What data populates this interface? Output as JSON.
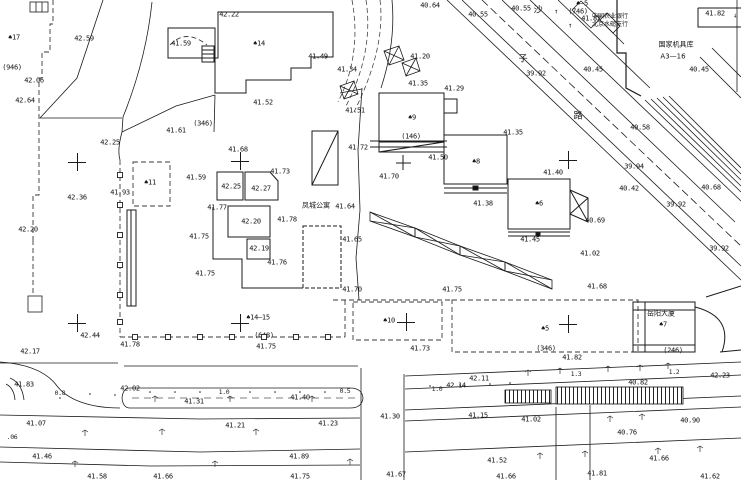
{
  "canvas": {
    "width": 741,
    "height": 480,
    "background": "#ffffff",
    "line_color": "#1b1b1b"
  },
  "annotations": [
    {
      "t": "40.64",
      "x": 430,
      "y": 6,
      "c": "e"
    },
    {
      "t": "40.55",
      "x": 478,
      "y": 15,
      "c": "e"
    },
    {
      "t": "40.55",
      "x": 521,
      "y": 9,
      "c": "e"
    },
    {
      "t": "♠—5",
      "x": 582,
      "y": 4,
      "c": "b"
    },
    {
      "t": "(746)",
      "x": 578,
      "y": 12,
      "c": "b"
    },
    {
      "t": "41.82",
      "x": 591,
      "y": 19,
      "c": "e"
    },
    {
      "t": "中国农业银行",
      "x": 610,
      "y": 17,
      "c": "n2"
    },
    {
      "t": "北京水磓支行",
      "x": 610,
      "y": 25,
      "c": "n2"
    },
    {
      "t": "国家机具库",
      "x": 676,
      "y": 45,
      "c": "n"
    },
    {
      "t": "A3—16",
      "x": 673,
      "y": 57,
      "c": "n"
    },
    {
      "t": "41.82",
      "x": 715,
      "y": 14,
      "c": "e"
    },
    {
      "t": "↓",
      "x": 735,
      "y": 16,
      "c": "s"
    },
    {
      "t": "↑",
      "x": 556,
      "y": 12,
      "c": "s"
    },
    {
      "t": "↑",
      "x": 570,
      "y": 26,
      "c": "s"
    },
    {
      "t": "40.45",
      "x": 699,
      "y": 70,
      "c": "e"
    },
    {
      "t": "40.45",
      "x": 593,
      "y": 70,
      "c": "e"
    },
    {
      "t": "39.92",
      "x": 536,
      "y": 74,
      "c": "e"
    },
    {
      "t": "沙",
      "x": 538,
      "y": 11,
      "c": "c"
    },
    {
      "t": "子",
      "x": 523,
      "y": 60,
      "c": "c"
    },
    {
      "t": "路",
      "x": 578,
      "y": 117,
      "c": "c"
    },
    {
      "t": "40.58",
      "x": 640,
      "y": 128,
      "c": "e"
    },
    {
      "t": "39.94",
      "x": 634,
      "y": 167,
      "c": "e"
    },
    {
      "t": "40.42",
      "x": 629,
      "y": 189,
      "c": "e"
    },
    {
      "t": "40.68",
      "x": 711,
      "y": 188,
      "c": "e"
    },
    {
      "t": "39.92",
      "x": 676,
      "y": 205,
      "c": "e"
    },
    {
      "t": "39.92",
      "x": 719,
      "y": 249,
      "c": "e"
    },
    {
      "t": "42.22",
      "x": 229,
      "y": 15,
      "c": "e"
    },
    {
      "t": "42.59",
      "x": 84,
      "y": 39,
      "c": "e"
    },
    {
      "t": "♠17",
      "x": 14,
      "y": 38,
      "c": "b"
    },
    {
      "t": "(946)",
      "x": 12,
      "y": 68,
      "c": "b"
    },
    {
      "t": "42.06",
      "x": 34,
      "y": 81,
      "c": "e"
    },
    {
      "t": "42.64",
      "x": 25,
      "y": 101,
      "c": "e"
    },
    {
      "t": "42.25",
      "x": 110,
      "y": 143,
      "c": "e"
    },
    {
      "t": "41.59",
      "x": 181,
      "y": 44,
      "c": "e"
    },
    {
      "t": "41.61",
      "x": 176,
      "y": 131,
      "c": "e"
    },
    {
      "t": "(346)",
      "x": 203,
      "y": 124,
      "c": "b"
    },
    {
      "t": "♠14",
      "x": 259,
      "y": 44,
      "c": "b"
    },
    {
      "t": "41.52",
      "x": 263,
      "y": 103,
      "c": "e"
    },
    {
      "t": "41.49",
      "x": 318,
      "y": 57,
      "c": "e"
    },
    {
      "t": "41.51",
      "x": 355,
      "y": 111,
      "c": "e"
    },
    {
      "t": "41.34",
      "x": 347,
      "y": 70,
      "c": "e"
    },
    {
      "t": "41.20",
      "x": 420,
      "y": 57,
      "c": "e"
    },
    {
      "t": "41.29",
      "x": 454,
      "y": 89,
      "c": "e"
    },
    {
      "t": "41.35",
      "x": 418,
      "y": 84,
      "c": "e"
    },
    {
      "t": "41.35",
      "x": 513,
      "y": 133,
      "c": "e"
    },
    {
      "t": "41.72",
      "x": 358,
      "y": 148,
      "c": "e"
    },
    {
      "t": "41.50",
      "x": 438,
      "y": 158,
      "c": "e"
    },
    {
      "t": "41.70",
      "x": 389,
      "y": 177,
      "c": "e"
    },
    {
      "t": "♠9",
      "x": 412,
      "y": 118,
      "c": "b"
    },
    {
      "t": "(146)",
      "x": 411,
      "y": 137,
      "c": "b"
    },
    {
      "t": "♠8",
      "x": 476,
      "y": 162,
      "c": "b"
    },
    {
      "t": "41.38",
      "x": 483,
      "y": 204,
      "c": "e"
    },
    {
      "t": "♠6",
      "x": 539,
      "y": 204,
      "c": "b"
    },
    {
      "t": "41.40",
      "x": 553,
      "y": 173,
      "c": "e"
    },
    {
      "t": "41.45",
      "x": 530,
      "y": 240,
      "c": "e"
    },
    {
      "t": "40.69",
      "x": 595,
      "y": 221,
      "c": "e"
    },
    {
      "t": "41.02",
      "x": 590,
      "y": 254,
      "c": "e"
    },
    {
      "t": "41.68",
      "x": 597,
      "y": 287,
      "c": "e"
    },
    {
      "t": "42.36",
      "x": 77,
      "y": 198,
      "c": "e"
    },
    {
      "t": "42.20",
      "x": 28,
      "y": 230,
      "c": "e"
    },
    {
      "t": "41.93",
      "x": 120,
      "y": 193,
      "c": "e"
    },
    {
      "t": "♠11",
      "x": 150,
      "y": 183,
      "c": "b"
    },
    {
      "t": "41.59",
      "x": 196,
      "y": 178,
      "c": "e"
    },
    {
      "t": "41.68",
      "x": 238,
      "y": 150,
      "c": "e"
    },
    {
      "t": "41.73",
      "x": 280,
      "y": 172,
      "c": "e"
    },
    {
      "t": "42.25",
      "x": 231,
      "y": 187,
      "c": "e"
    },
    {
      "t": "42.27",
      "x": 261,
      "y": 189,
      "c": "e"
    },
    {
      "t": "41.77",
      "x": 217,
      "y": 208,
      "c": "e"
    },
    {
      "t": "42.20",
      "x": 251,
      "y": 222,
      "c": "e"
    },
    {
      "t": "41.78",
      "x": 287,
      "y": 220,
      "c": "e"
    },
    {
      "t": "41.64",
      "x": 345,
      "y": 207,
      "c": "e"
    },
    {
      "t": "凤城公寓",
      "x": 316,
      "y": 206,
      "c": "n"
    },
    {
      "t": "41.75",
      "x": 199,
      "y": 237,
      "c": "e"
    },
    {
      "t": "42.19",
      "x": 259,
      "y": 249,
      "c": "e"
    },
    {
      "t": "41.76",
      "x": 277,
      "y": 263,
      "c": "e"
    },
    {
      "t": "41.75",
      "x": 205,
      "y": 274,
      "c": "e"
    },
    {
      "t": "41.65",
      "x": 352,
      "y": 240,
      "c": "e"
    },
    {
      "t": "41.70",
      "x": 352,
      "y": 290,
      "c": "e"
    },
    {
      "t": "41.75",
      "x": 452,
      "y": 290,
      "c": "e"
    },
    {
      "t": "♠10",
      "x": 389,
      "y": 321,
      "c": "b"
    },
    {
      "t": "♠14—15",
      "x": 258,
      "y": 318,
      "c": "b"
    },
    {
      "t": "(648)",
      "x": 264,
      "y": 336,
      "c": "b"
    },
    {
      "t": "41.75",
      "x": 266,
      "y": 347,
      "c": "e"
    },
    {
      "t": "41.73",
      "x": 420,
      "y": 349,
      "c": "e"
    },
    {
      "t": "♠5",
      "x": 545,
      "y": 329,
      "c": "b"
    },
    {
      "t": "(346)",
      "x": 546,
      "y": 349,
      "c": "b"
    },
    {
      "t": "41.82",
      "x": 572,
      "y": 358,
      "c": "e"
    },
    {
      "t": "岳阳大厦",
      "x": 661,
      "y": 314,
      "c": "n"
    },
    {
      "t": "♠7",
      "x": 663,
      "y": 325,
      "c": "b"
    },
    {
      "t": "(246)",
      "x": 673,
      "y": 351,
      "c": "b"
    },
    {
      "t": "42.23",
      "x": 720,
      "y": 376,
      "c": "e"
    },
    {
      "t": "40.82",
      "x": 638,
      "y": 383,
      "c": "e"
    },
    {
      "t": "42.17",
      "x": 30,
      "y": 352,
      "c": "e"
    },
    {
      "t": "42.44",
      "x": 90,
      "y": 336,
      "c": "e"
    },
    {
      "t": "41.78",
      "x": 130,
      "y": 345,
      "c": "e"
    },
    {
      "t": "41.83",
      "x": 24,
      "y": 385,
      "c": "e"
    },
    {
      "t": "42.02",
      "x": 130,
      "y": 389,
      "c": "e"
    },
    {
      "t": "0.8",
      "x": 60,
      "y": 393,
      "c": "d"
    },
    {
      "t": "1.0",
      "x": 224,
      "y": 392,
      "c": "d"
    },
    {
      "t": "41.31",
      "x": 194,
      "y": 402,
      "c": "e"
    },
    {
      "t": "41.07",
      "x": 36,
      "y": 424,
      "c": "e"
    },
    {
      "t": ".06",
      "x": 12,
      "y": 437,
      "c": "d"
    },
    {
      "t": "41.21",
      "x": 235,
      "y": 426,
      "c": "e"
    },
    {
      "t": "41.46",
      "x": 42,
      "y": 457,
      "c": "e"
    },
    {
      "t": "41.58",
      "x": 97,
      "y": 477,
      "c": "e"
    },
    {
      "t": "41.66",
      "x": 163,
      "y": 477,
      "c": "e"
    },
    {
      "t": "41.75",
      "x": 300,
      "y": 477,
      "c": "e"
    },
    {
      "t": "41.89",
      "x": 299,
      "y": 457,
      "c": "e"
    },
    {
      "t": "0.5",
      "x": 345,
      "y": 391,
      "c": "d"
    },
    {
      "t": "41.40",
      "x": 300,
      "y": 398,
      "c": "e"
    },
    {
      "t": "41.30",
      "x": 390,
      "y": 417,
      "c": "e"
    },
    {
      "t": "41.23",
      "x": 328,
      "y": 424,
      "c": "e"
    },
    {
      "t": "41.15",
      "x": 478,
      "y": 416,
      "c": "e"
    },
    {
      "t": "1.0",
      "x": 437,
      "y": 389,
      "c": "d"
    },
    {
      "t": "42.14",
      "x": 456,
      "y": 386,
      "c": "e"
    },
    {
      "t": "42.11",
      "x": 479,
      "y": 379,
      "c": "e"
    },
    {
      "t": "1.3",
      "x": 576,
      "y": 374,
      "c": "d"
    },
    {
      "t": "1.2",
      "x": 674,
      "y": 372,
      "c": "d"
    },
    {
      "t": "41.02",
      "x": 531,
      "y": 420,
      "c": "e"
    },
    {
      "t": "40.90",
      "x": 690,
      "y": 421,
      "c": "e"
    },
    {
      "t": "40.76",
      "x": 627,
      "y": 433,
      "c": "e"
    },
    {
      "t": "41.66",
      "x": 659,
      "y": 459,
      "c": "e"
    },
    {
      "t": "41.52",
      "x": 497,
      "y": 461,
      "c": "e"
    },
    {
      "t": "41.67",
      "x": 396,
      "y": 475,
      "c": "e"
    },
    {
      "t": "41.66",
      "x": 506,
      "y": 477,
      "c": "e"
    },
    {
      "t": "41.81",
      "x": 597,
      "y": 474,
      "c": "e"
    },
    {
      "t": "41.62",
      "x": 710,
      "y": 477,
      "c": "e"
    }
  ],
  "crosses": [
    [
      77,
      162
    ],
    [
      240,
      161
    ],
    [
      568,
      160
    ],
    [
      77,
      323
    ],
    [
      240,
      323
    ],
    [
      406,
      322
    ],
    [
      568,
      324
    ]
  ],
  "fence_squares": [
    [
      135,
      337
    ],
    [
      168,
      337
    ],
    [
      200,
      337
    ],
    [
      232,
      337
    ],
    [
      264,
      337
    ],
    [
      296,
      337
    ],
    [
      328,
      337
    ],
    [
      120,
      175
    ],
    [
      120,
      205
    ],
    [
      120,
      235
    ],
    [
      120,
      265
    ],
    [
      120,
      295
    ],
    [
      120,
      322
    ]
  ]
}
